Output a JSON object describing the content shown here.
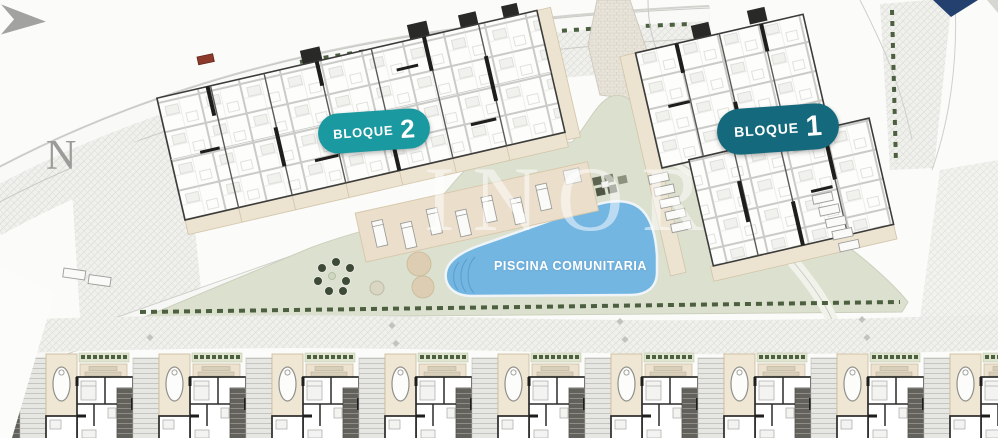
{
  "site": {
    "north_label": "N",
    "watermark_text": "INOR",
    "badge_bloque2": {
      "label": "BLOQUE",
      "number": "2",
      "color": "#1b99a1"
    },
    "badge_bloque1": {
      "label": "BLOQUE",
      "number": "1",
      "color": "#14697c"
    },
    "pool_label": "PISCINA COMUNITARIA",
    "bottom_row_unit_count": 9,
    "colors": {
      "pool_water": "#74b6e2",
      "deck_beige": "#ebdfcc",
      "lawn_green": "#dce1cf",
      "hedge_green": "#4c6040",
      "paving_gray": "#f1f1ee",
      "corner_navy": "#23406f"
    }
  }
}
